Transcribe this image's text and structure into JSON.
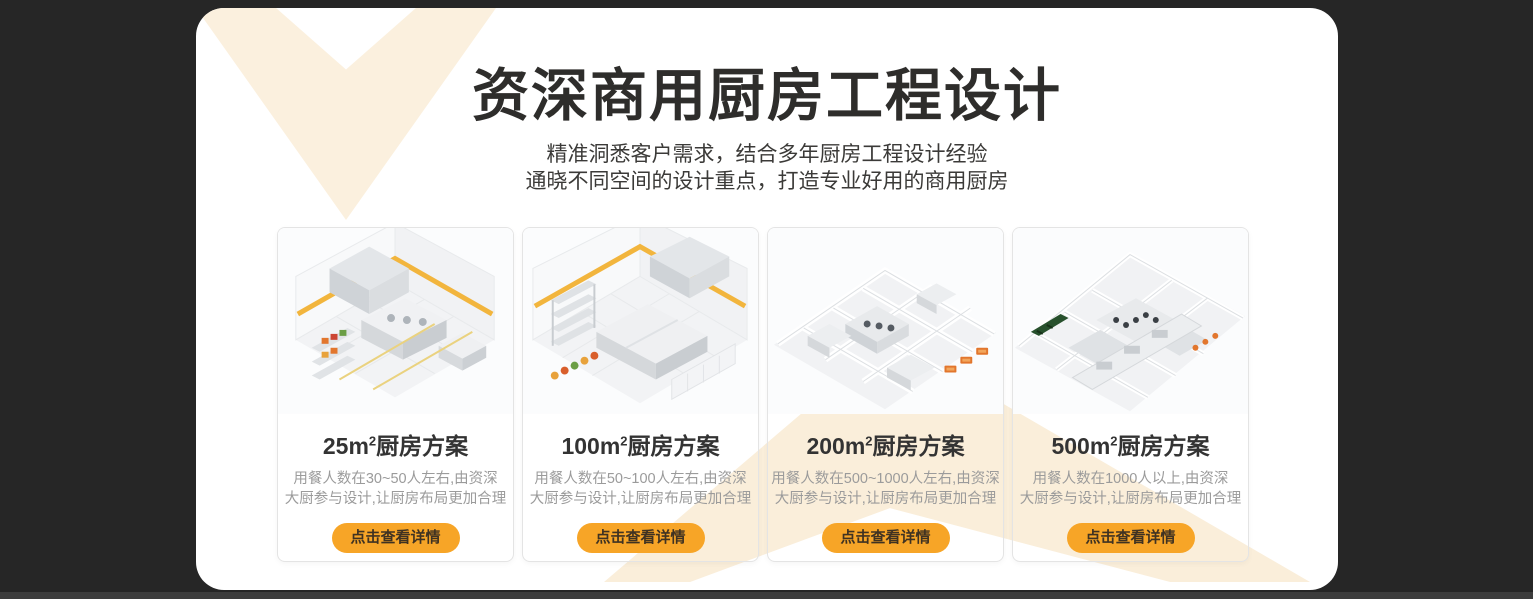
{
  "colors": {
    "page_background": "#262626",
    "panel_background": "#ffffff",
    "decor_cream": "#fbf0de",
    "accent_orange": "#f7a527",
    "button_text": "#3f3222",
    "footer_strip": "#3d3d3d"
  },
  "header": {
    "title": "资深商用厨房工程设计",
    "subtitle_line1": "精准洞悉客户需求，结合多年厨房工程设计经验",
    "subtitle_line2": "通晓不同空间的设计重点，打造专业好用的商用厨房"
  },
  "cards": [
    {
      "area": "25m",
      "exponent": "2",
      "title_suffix": "厨房方案",
      "desc_line1": "用餐人数在30~50人左右,由资深",
      "desc_line2": "大厨参与设计,让厨房布局更加合理",
      "button_label": "点击查看详情"
    },
    {
      "area": "100m",
      "exponent": "2",
      "title_suffix": "厨房方案",
      "desc_line1": "用餐人数在50~100人左右,由资深",
      "desc_line2": "大厨参与设计,让厨房布局更加合理",
      "button_label": "点击查看详情"
    },
    {
      "area": "200m",
      "exponent": "2",
      "title_suffix": "厨房方案",
      "desc_line1": "用餐人数在500~1000人左右,由资深",
      "desc_line2": "大厨参与设计,让厨房布局更加合理",
      "button_label": "点击查看详情"
    },
    {
      "area": "500m",
      "exponent": "2",
      "title_suffix": "厨房方案",
      "desc_line1": "用餐人数在1000人以上,由资深",
      "desc_line2": "大厨参与设计,让厨房布局更加合理",
      "button_label": "点击查看详情"
    }
  ]
}
